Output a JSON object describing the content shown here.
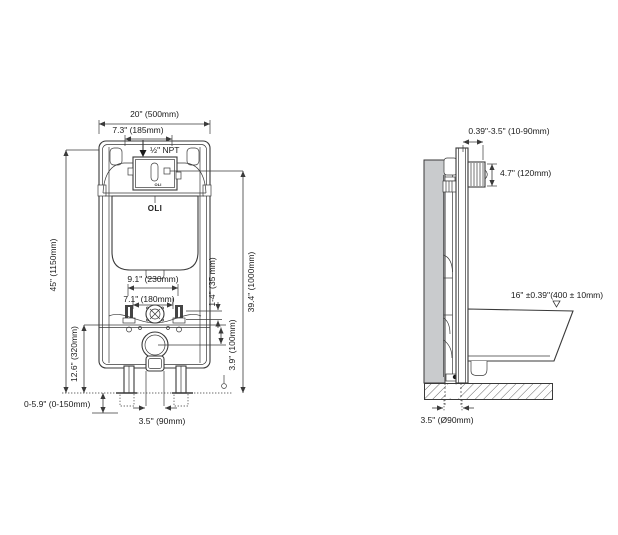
{
  "drawing": {
    "brand": "OLI",
    "colors": {
      "line": "#3a3a3a",
      "wall_fill": "#c9cbcd",
      "background": "#ffffff"
    },
    "front_view": {
      "total_width": "20\" (500mm)",
      "access_width": "7.3\" (185mm)",
      "supply_thread": "½\" NPT",
      "outer_bolt_spacing": "9.1\" (230mm)",
      "inner_bolt_spacing": "7.1\" (180mm)",
      "bolt_adjust": "1-4\" (35 mm)",
      "actuator_height": "39.4\" (1000mm)",
      "drain_offset": "3.9\" (100mm)",
      "total_height": "45\" (1150mm)",
      "bracket_height": "12.6\" (320mm)",
      "leg_adjust": "0-5.9\" (0-150mm)",
      "drain_width": "3.5'' (90mm)"
    },
    "side_view": {
      "wall_finish_range": "0.39\"-3.5\" (10-90mm)",
      "actuator_size": "4.7\" (120mm)",
      "rim_height": "16\" ±0.39''(400 ± 10mm)",
      "drain_diameter": "3.5\" (Ø90mm)"
    }
  }
}
